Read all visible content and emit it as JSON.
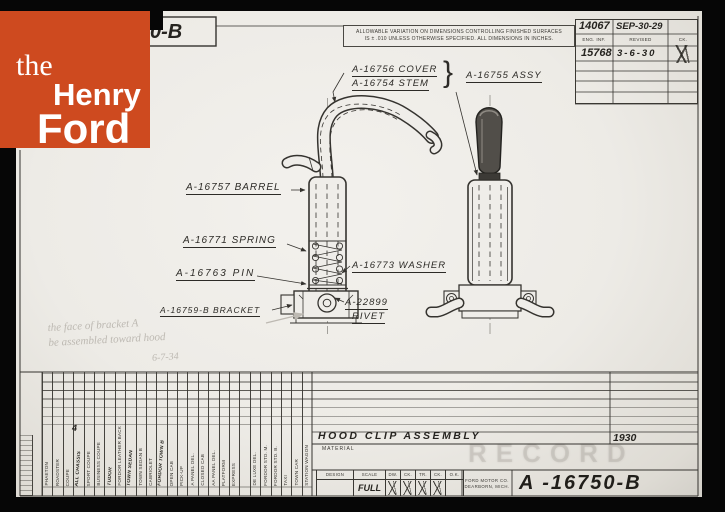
{
  "logo": {
    "word1": "the",
    "word2": "Henry",
    "word3": "Ford",
    "bg_color": "#CE4A1F"
  },
  "stamp_box": {
    "number": "0-B"
  },
  "tolerance": {
    "line1": "ALLOWABLE VARIATION ON DIMENSIONS CONTROLLING FINISHED SURFACES",
    "line2": "IS ± .010 UNLESS OTHERWISE SPECIFIED.   ALL DIMENSIONS IN INCHES."
  },
  "revision_table": {
    "h_eng": "ENG. INF.",
    "h_rev": "REVISED",
    "h_ck": "CK.",
    "r1_num": "14067",
    "r1_date": "SEP-30-29",
    "r2_num": "15768",
    "r2_date": "3-6-30"
  },
  "labels": {
    "cover": "A-16756  COVER",
    "stem": "A-16754  STEM",
    "brace": "}",
    "assy": "A-16755  ASSY",
    "barrel": "A-16757  BARREL",
    "spring": "A-16771  SPRING",
    "pin": "A-16763  PIN",
    "bracket": "A-16759-B  BRACKET",
    "washer": "A-16773  WASHER",
    "rivet_no": "A-22899",
    "rivet": "RIVET"
  },
  "pencil_note": {
    "line1": "the face of bracket A",
    "line2": "be assembled toward hood",
    "line3": "6-7-34"
  },
  "title_block": {
    "title": "HOOD CLIP ASSEMBLY",
    "material": "MATERIAL",
    "year": "1930",
    "qty": "4",
    "watermark": "RECORD",
    "body_types": [
      {
        "label": "PHAETON"
      },
      {
        "label": "ROADSTER"
      },
      {
        "label": "COUPE"
      },
      {
        "label": "ALL CHASSIS",
        "hw": true
      },
      {
        "label": "SPORT COUPE"
      },
      {
        "label": "BUSINESS COUPE"
      },
      {
        "label": "TUDOR",
        "hw": true
      },
      {
        "label": "FORDOR LEATHER BACK"
      },
      {
        "label": "TOWN SEDAN",
        "hw": true
      },
      {
        "label": "TOWN SEDAN B"
      },
      {
        "label": "CABRIOLET"
      },
      {
        "label": "FORDOR TOWN B",
        "hw": true
      },
      {
        "label": "OPEN CAB"
      },
      {
        "label": "PICK-UP"
      },
      {
        "label": "A PANEL DEL."
      },
      {
        "label": "CLOSED CAB"
      },
      {
        "label": "AA PANEL DEL."
      },
      {
        "label": "PLATFORM"
      },
      {
        "label": "EXPRESS"
      },
      {
        "label": ""
      },
      {
        "label": "DE LUXE DEL."
      },
      {
        "label": "FORDOR STD. M."
      },
      {
        "label": "FORDOR STD. B."
      },
      {
        "label": "TAXI"
      },
      {
        "label": "TOWN CAR"
      },
      {
        "label": "STATION WAGON"
      }
    ],
    "approvals": {
      "headers": [
        "DESIGN",
        "SCALE",
        "DW.",
        "CK.",
        "TR.",
        "CK.",
        "O.K."
      ],
      "scale_value": "FULL"
    },
    "company": {
      "line1": "FORD MOTOR CO.",
      "line2": "DEARBORN, MICH."
    },
    "drawing_number": "A -16750-B"
  }
}
